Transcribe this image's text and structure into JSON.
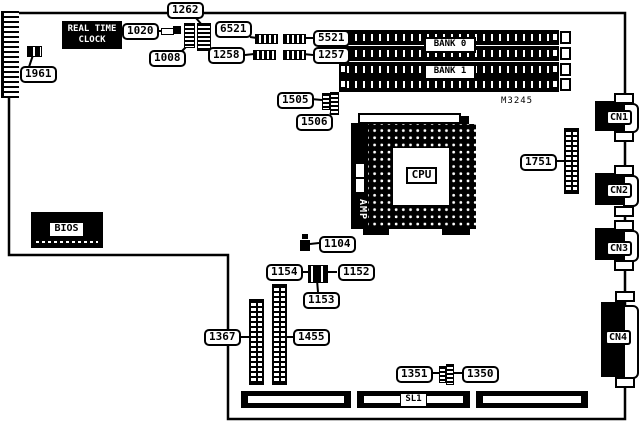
{
  "diagram": {
    "type": "motherboard-layout",
    "model": "M3245",
    "colors": {
      "ink": "#000000",
      "paper": "#ffffff"
    },
    "silkscreen": {
      "rtc_line1": "REAL TIME",
      "rtc_line2": "CLOCK",
      "bios": "BIOS",
      "cpu": "CPU",
      "amp": "AMP",
      "bank0": "BANK 0",
      "bank1": "BANK 1",
      "sl1": "SL1",
      "cn1": "CN1",
      "cn2": "CN2",
      "cn3": "CN3",
      "cn4": "CN4"
    },
    "callouts": {
      "c1961": "1961",
      "c1020": "1020",
      "c1262": "1262",
      "c1008": "1008",
      "c6521": "6521",
      "c5521": "5521",
      "c1258": "1258",
      "c1257": "1257",
      "c1505": "1505",
      "c1506": "1506",
      "c1751": "1751",
      "c1104": "1104",
      "c1154": "1154",
      "c1152": "1152",
      "c1153": "1153",
      "c1367": "1367",
      "c1455": "1455",
      "c1351": "1351",
      "c1350": "1350"
    }
  }
}
